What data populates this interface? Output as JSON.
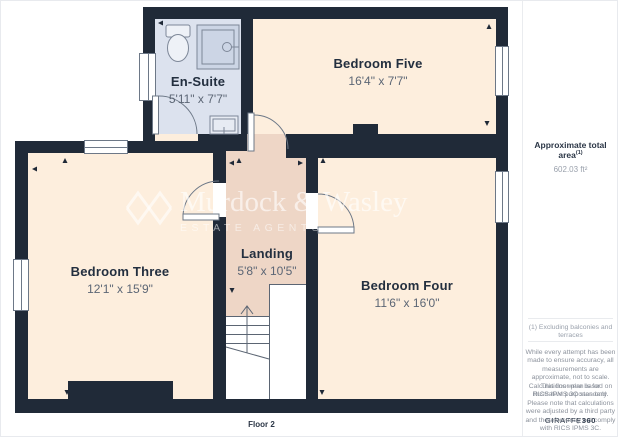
{
  "plan": {
    "floor_label": "Floor 2",
    "rooms": {
      "ensuite": {
        "name": "En-Suite",
        "dims": "5'11\" x 7'7\""
      },
      "bedroom_five": {
        "name": "Bedroom Five",
        "dims": "16'4\" x 7'7\""
      },
      "bedroom_three": {
        "name": "Bedroom Three",
        "dims": "12'1\" x 15'9\""
      },
      "landing": {
        "name": "Landing",
        "dims": "5'8\" x 10'5\""
      },
      "bedroom_four": {
        "name": "Bedroom Four",
        "dims": "11'6\" x 16'0\""
      }
    },
    "fixtures": [
      "toilet",
      "shower",
      "sink",
      "staircase-up"
    ]
  },
  "watermark": {
    "name": "Murdock & Wasley",
    "tagline": "ESTATE AGENTS"
  },
  "sidebar": {
    "area_label": "Approximate total area",
    "area_footnote_marker": "(1)",
    "area_value": "602.03 ft²",
    "footnote": "(1) Excluding balconies and terraces",
    "disclaimer_1": "While every attempt has been made to ensure accuracy, all measurements are approximate, not to scale. This floor plan is for illustrative purposes only.",
    "disclaimer_2": "Calculations were based on RICS IPMS 3C standard. Please note that calculations were adjusted by a third party and therefore may not comply with RICS IPMS 3C.",
    "brand": "GIRAFFE",
    "brand_suffix": "360"
  },
  "colors": {
    "wall": "#202a38",
    "bedroom_fill": "#fdeedd",
    "landing_fill": "#eed6c6",
    "ensuite_fill": "#dce2ee",
    "label_text": "#232f3f",
    "dims_text": "#5c6675",
    "fixture_line": "#7d8798"
  }
}
